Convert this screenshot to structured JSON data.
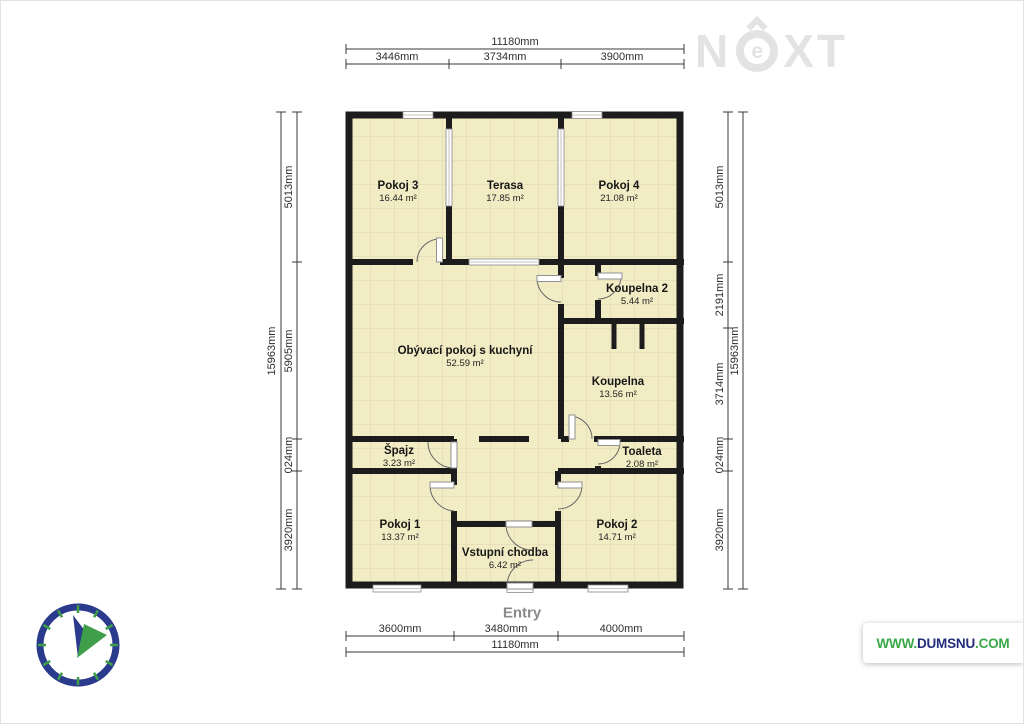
{
  "watermark": {
    "n": "N",
    "e": "e",
    "xt": "XT"
  },
  "rooms": [
    {
      "id": "pokoj-3",
      "name": "Pokoj 3",
      "area": "16.44 m²"
    },
    {
      "id": "terasa",
      "name": "Terasa",
      "area": "17.85 m²"
    },
    {
      "id": "pokoj-4",
      "name": "Pokoj 4",
      "area": "21.08 m²"
    },
    {
      "id": "koupelna-2",
      "name": "Koupelna 2",
      "area": "5.44 m²"
    },
    {
      "id": "obyvaci-pokoj-s-kuchyni",
      "name": "Obývací pokoj s kuchyní",
      "area": "52.59 m²"
    },
    {
      "id": "koupelna",
      "name": "Koupelna",
      "area": "13.56 m²"
    },
    {
      "id": "spajz",
      "name": "Špajz",
      "area": "3.23 m²"
    },
    {
      "id": "toaleta",
      "name": "Toaleta",
      "area": "2.08 m²"
    },
    {
      "id": "pokoj-1",
      "name": "Pokoj 1",
      "area": "13.37 m²"
    },
    {
      "id": "pokoj-2",
      "name": "Pokoj 2",
      "area": "14.71 m²"
    },
    {
      "id": "vstupni-chodba",
      "name": "Vstupní chodba",
      "area": "6.42 m²"
    }
  ],
  "entry_label": "Entry",
  "dimensions": {
    "top": {
      "total": "11180mm",
      "segments": [
        "3446mm",
        "3734mm",
        "3900mm"
      ]
    },
    "bottom": {
      "total": "11180mm",
      "segments": [
        "3600mm",
        "3480mm",
        "4000mm"
      ]
    },
    "left": {
      "total": "15963mm",
      "segments": [
        "5013mm",
        "5905mm",
        "024mm",
        "3920mm"
      ]
    },
    "right": {
      "total": "15963mm",
      "segments": [
        "5013mm",
        "2191mm",
        "3714mm",
        "024mm",
        "3920mm"
      ]
    }
  },
  "branding": {
    "www": "WWW.",
    "domain": "DUMSNU",
    "tld": ".COM"
  },
  "colors": {
    "wall": "#1c1c1c",
    "floor": "#f2ecc5",
    "tile_line": "#ddd5ae",
    "navy": "#2a3a8c",
    "green": "#3f9e49",
    "watermark_gray": "#e3e3e3",
    "dimension_line": "#3a3a3a"
  }
}
